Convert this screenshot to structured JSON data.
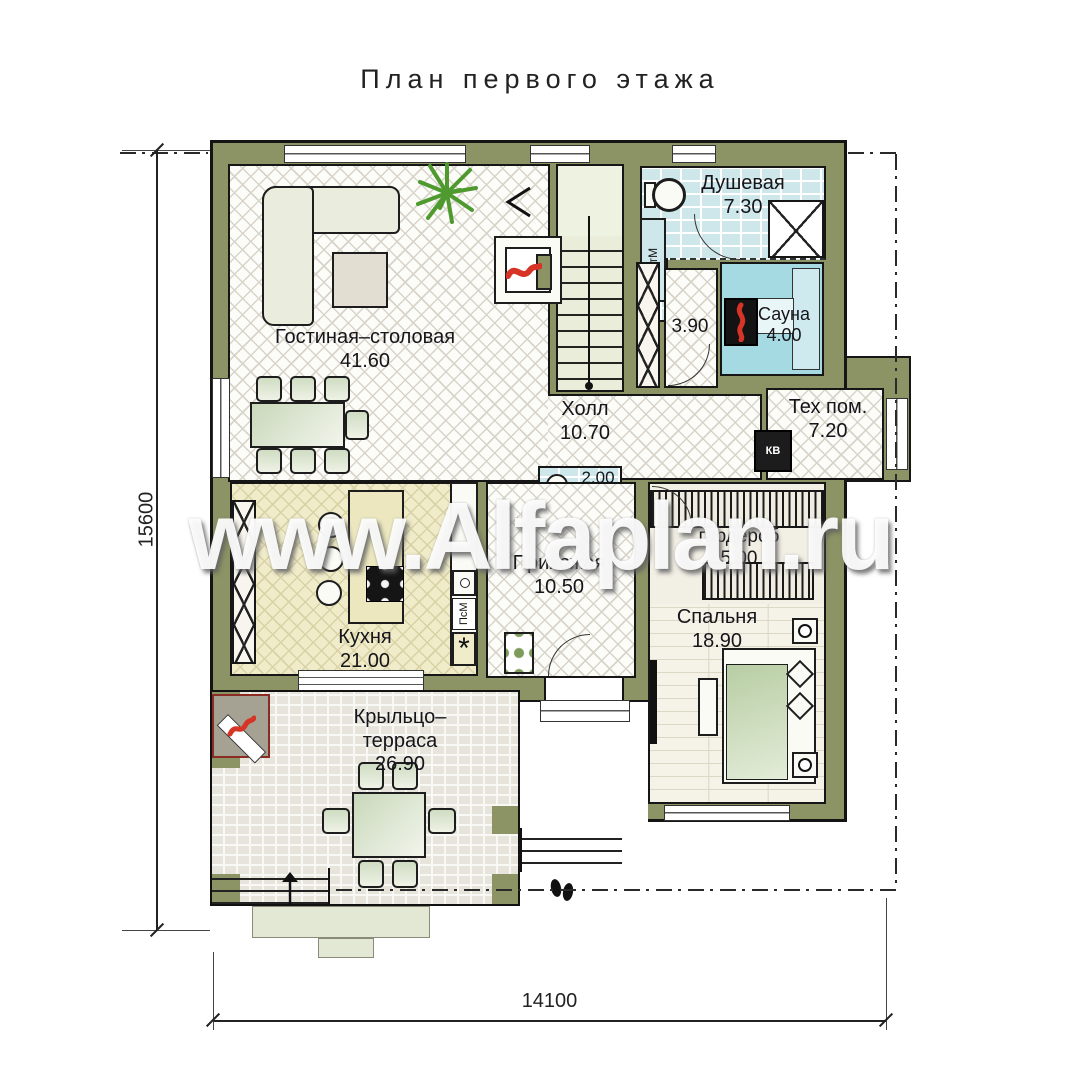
{
  "title": "План первого этажа",
  "watermark": "www.Alfaplan.ru",
  "dimensions": {
    "left": "15600",
    "bottom": "14100"
  },
  "rooms": {
    "living": {
      "name": "Гостиная–столовая",
      "area": "41.60"
    },
    "shower": {
      "name": "Душевая",
      "area": "7.30"
    },
    "corridor": {
      "area": "3.90"
    },
    "sauna": {
      "name": "Сауна",
      "area": "4.00"
    },
    "hall": {
      "name": "Холл",
      "area": "10.70"
    },
    "tech": {
      "name": "Тех пом.",
      "area": "7.20"
    },
    "kitchen": {
      "name": "Кухня",
      "area": "21.00"
    },
    "wc": {
      "area": "2.00"
    },
    "entry": {
      "name": "Прихожая",
      "area": "10.50"
    },
    "wardrobe": {
      "name": "гардероб",
      "area": "5.00"
    },
    "bedroom": {
      "name": "Спальня",
      "area": "18.90"
    },
    "terrace": {
      "name": "Крыльцо–\nтерраса",
      "area": "26.90"
    }
  },
  "appliances": {
    "washer": "СтМ",
    "dishwasher": "ПсМ",
    "boiler": "КВ",
    "burner_symbol": "*"
  },
  "colors": {
    "wall": "#8c9365",
    "wet_floor": "#cde7ea",
    "sauna_floor": "#a5dae2",
    "kitchen_floor": "#f0ecca",
    "flame_red": "#d63426",
    "plant_green": "#4f9a2f"
  }
}
